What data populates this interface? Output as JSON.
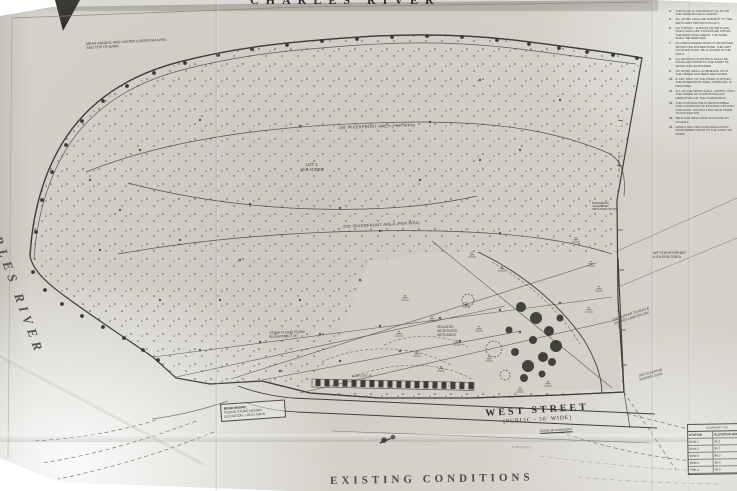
{
  "colors": {
    "paper": "#d4d1ca",
    "ink": "#3f3e39",
    "faint": "#8d8b82"
  },
  "top_title": "CHARLES RIVER",
  "left_river_label": "CHARLES RIVER",
  "sheet_title": "EXISTING CONDITIONS",
  "notes": {
    "items": [
      {
        "num": "4.",
        "text": "THIS PLAN IS THE RESULT OF AN ON THE GROUND FIELD SURVEY."
      },
      {
        "num": "5.",
        "text": "ALL WORK SHALL BE SUBJECT TO THE WETLANDS PROTECTION ACT."
      },
      {
        "num": "6.",
        "text": "NO TOPSOIL, SUBSOIL OR WETLAND SOILS SHALL BE STOCKPILED WITHIN THE RESOURCE AREAS. THE SAME SHALL BE REMOVED."
      },
      {
        "num": "7.",
        "text": "IN CASES WHERE WORK IS PROPOSED WITHIN THE BUFFER ZONE, THE LIMIT OF WORK SHALL BE FLAGGED IN THE FIELD."
      },
      {
        "num": "8.",
        "text": "ALL EROSION CONTROLS SHALL BE INSTALLED PRIOR TO THE START OF WORK AND MAINTAINED."
      },
      {
        "num": "9.",
        "text": "NO WORK SHALL COMMENCE UNTIL THE ORDER HAS BEEN RECORDED."
      },
      {
        "num": "10.",
        "text": "IF ANY PART OF THE WORK IS WITHIN THE RIVERFRONT AREA, APPROVAL IS REQUIRED."
      },
      {
        "num": "11.",
        "text": "ALL OF THE WORK SHALL COMPLY WITH THE ORDER OF CONDITIONS AND DIRECTIVES OF THE COMMISSION."
      },
      {
        "num": "12.",
        "text": "THE CONTRACTOR IS RESPONSIBLE FOR LOCATIONS OF EXISTING UTILITIES AND SHALL CONTACT DIG SAFE PRIOR TO EXCAVATION."
      },
      {
        "num": "13.",
        "text": "WETLAND RESOURCE FLAGGING BY OTHERS."
      },
      {
        "num": "14.",
        "text": "HAVE A SOIL WETLAND EVALUATION PERFORMED PRIOR TO THE START OF WORK."
      }
    ]
  },
  "labels": {
    "mean_high_water_1": "MEAN ANNUAL HIGH WATER (UNDER MA WPA)",
    "mean_high_water_2": "AND TOP OF BANK",
    "riverfront_100": "100' RIVERFRONT AREA (PER WPA)",
    "lot_name": "LOT 1",
    "lot_area": "±8.4 ACRES",
    "riverfront_200": "200' RIVERFRONT AREA (PER WPA)",
    "bvw": "BORDERING VEGETATED WETLANDS (BVW)",
    "owner_1": "N/F CHRISTOPHER",
    "owner_2": "& EILEEN O'DEA",
    "isolated_1": "ISOLATED",
    "isolated_2": "VEGETATED",
    "isolated_3": "WETLANDS",
    "fema_1": "FEMA FLOOD PLAIN",
    "fema_2": "ELEVATION = 87",
    "buffer_1": "100' BUFFER TO BVW &",
    "buffer_2": "100' WETLAND BYLAW",
    "clearing_1": "100' CLEARING",
    "clearing_2": "BUFFER ZONE",
    "benchmark_1": "BENCHMARK:",
    "benchmark_2": "FOUND STONE BOUND",
    "benchmark_3": "ELEVATION = 85.91 NAVD",
    "west_street": "WEST STREET",
    "west_street_sub": "(PUBLIC - 50' WIDE)",
    "edge_of_pavement": "EDGE OF PAVEMENT",
    "bearing_right": "S 01°34'25\" W",
    "bearing_wall": "N 88°51'05\" W",
    "faint_bottom": "S 34°29'48\" E"
  },
  "table": {
    "title": "SUMMARY OF",
    "col_station": "STATION",
    "col_elev": "ELEVATION BUFFER",
    "rows": [
      {
        "station": "BVW-1",
        "elev": "86.2"
      },
      {
        "station": "BVW-2",
        "elev": "85.7"
      },
      {
        "station": "BVW-3",
        "elev": "86.0"
      },
      {
        "station": "BVW-4",
        "elev": "85.4"
      },
      {
        "station": "TBM-A",
        "elev": "85.9"
      }
    ]
  }
}
